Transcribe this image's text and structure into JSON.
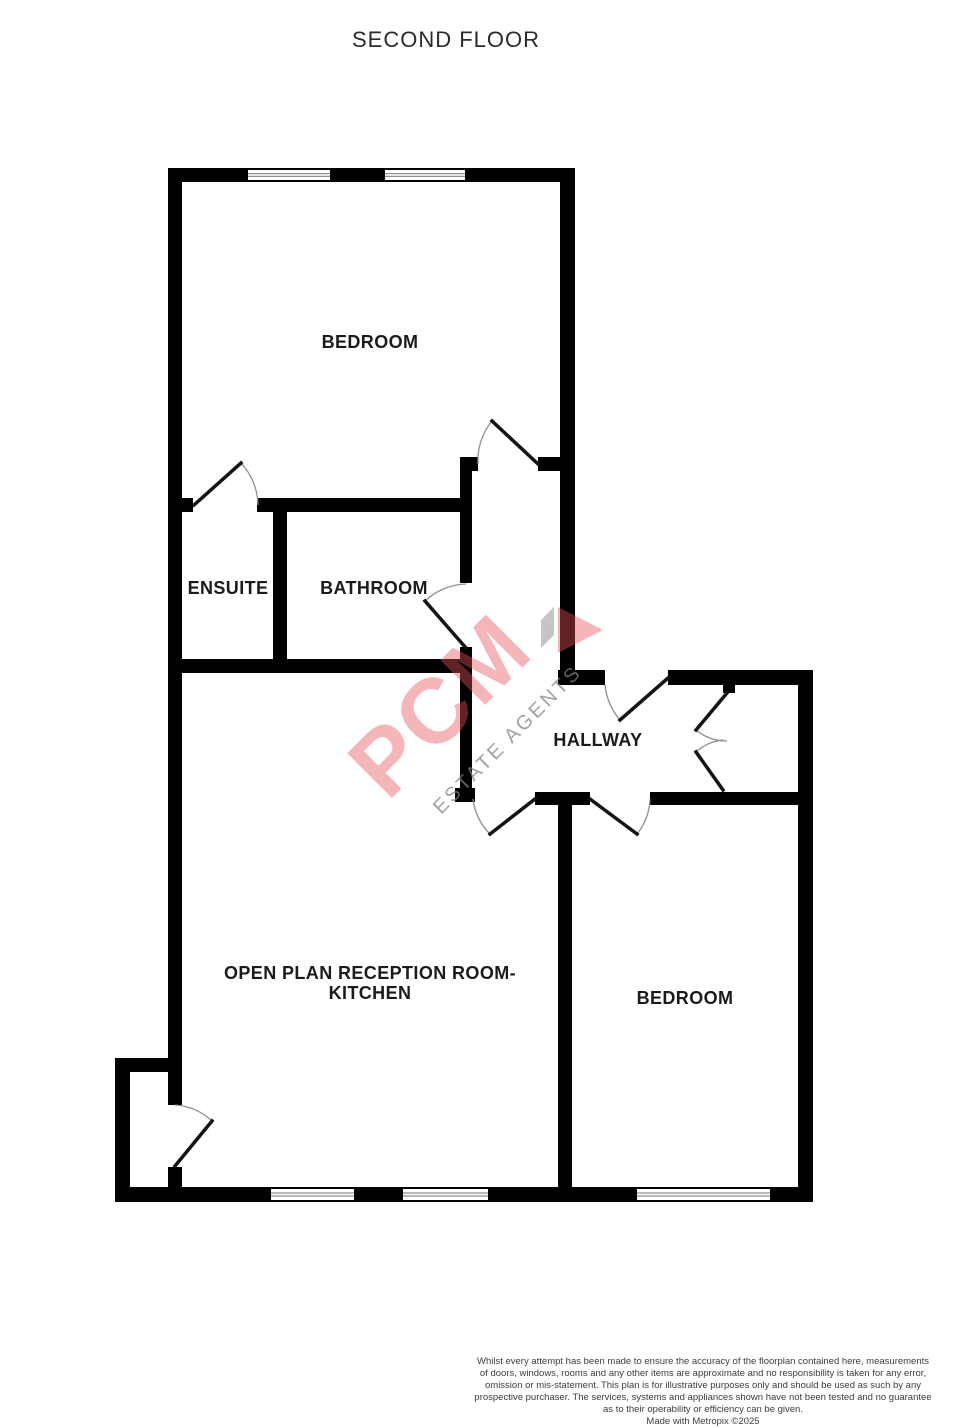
{
  "title": "SECOND FLOOR",
  "style": {
    "wall_color": "#000000",
    "door_leaf_color": "#141414",
    "door_arc_color": "#8f8f8f",
    "window_line_color": "#8f8f8f",
    "label_color": "#1b1b1b"
  },
  "watermark": {
    "texts": [
      {
        "text": "PCM",
        "x": 462,
        "y": 728,
        "size": 92,
        "rotate": -45,
        "color": "rgba(232,80,90,0.42)",
        "weight": "bold",
        "spacing": 2
      },
      {
        "text": "ESTATE AGENTS",
        "x": 512,
        "y": 744,
        "size": 20,
        "rotate": -45,
        "color": "rgba(130,130,130,0.75)",
        "weight": "normal",
        "spacing": 3
      }
    ],
    "polygons": [
      {
        "name": "watermark-gray-bar",
        "points": "541,648 541,620 554,607 554,635",
        "color": "rgba(150,150,150,0.55)"
      },
      {
        "name": "watermark-arrow",
        "points": "558,607 603,630 558,653",
        "color": "rgba(232,80,90,0.42)"
      }
    ]
  },
  "plan": {
    "walls": [
      [
        168,
        168,
        80,
        14
      ],
      [
        330,
        168,
        55,
        14
      ],
      [
        465,
        168,
        110,
        14
      ],
      [
        168,
        168,
        14,
        904
      ],
      [
        560,
        168,
        15,
        517
      ],
      [
        168,
        498,
        25,
        14
      ],
      [
        257,
        498,
        215,
        14
      ],
      [
        460,
        457,
        18,
        14
      ],
      [
        538,
        457,
        22,
        14
      ],
      [
        273,
        512,
        14,
        148
      ],
      [
        168,
        659,
        304,
        14
      ],
      [
        460,
        471,
        12,
        112
      ],
      [
        460,
        647,
        12,
        141
      ],
      [
        455,
        788,
        20,
        14
      ],
      [
        558,
        670,
        47,
        15
      ],
      [
        668,
        670,
        145,
        15
      ],
      [
        723,
        683,
        12,
        10
      ],
      [
        798,
        670,
        15,
        532
      ],
      [
        535,
        792,
        55,
        13
      ],
      [
        650,
        792,
        155,
        13
      ],
      [
        558,
        792,
        14,
        410
      ],
      [
        115,
        1058,
        67,
        14
      ],
      [
        115,
        1058,
        15,
        144
      ],
      [
        168,
        1072,
        14,
        33
      ],
      [
        168,
        1167,
        14,
        20
      ],
      [
        115,
        1187,
        156,
        15
      ],
      [
        354,
        1187,
        49,
        15
      ],
      [
        488,
        1187,
        149,
        15
      ],
      [
        770,
        1187,
        43,
        15
      ]
    ],
    "windows": [
      [
        248,
        168,
        82,
        14
      ],
      [
        385,
        168,
        80,
        14
      ],
      [
        271,
        1187,
        83,
        15
      ],
      [
        403,
        1187,
        85,
        15
      ],
      [
        637,
        1187,
        133,
        15
      ]
    ],
    "doors": [
      {
        "name": "ensuite-door",
        "leaf": [
          194,
          505,
          241,
          463
        ],
        "arc": "M241,463 A63,63 0 0 1 258,505"
      },
      {
        "name": "bedroom-top-door",
        "leaf": [
          538,
          464,
          492,
          421
        ],
        "arc": "M492,421 A62,62 0 0 0 478,464"
      },
      {
        "name": "bathroom-door",
        "leaf": [
          466,
          648,
          425,
          601
        ],
        "arc": "M425,601 A63,63 0 0 1 466,584"
      },
      {
        "name": "hallway-top-door",
        "leaf": [
          668,
          678,
          620,
          720
        ],
        "arc": "M620,720 A64,64 0 0 1 605,685"
      },
      {
        "name": "entrance-door-upper",
        "leaf": [
          727,
          693,
          696,
          730
        ],
        "arc": "M727,741 A48,48 0 0 1 696,730"
      },
      {
        "name": "entrance-door-lower",
        "leaf": [
          723,
          790,
          696,
          752
        ],
        "arc": "M723,740 A48,48 0 0 0 696,752"
      },
      {
        "name": "reception-door",
        "leaf": [
          535,
          799,
          490,
          834
        ],
        "arc": "M473,799 A60,60 0 0 0 490,834"
      },
      {
        "name": "bedroom-right-door",
        "leaf": [
          590,
          799,
          637,
          834
        ],
        "arc": "M650,799 A59,59 0 0 1 637,834"
      },
      {
        "name": "lobby-door",
        "leaf": [
          175,
          1166,
          212,
          1121
        ],
        "arc": "M175,1105 A60,60 0 0 1 212,1121"
      }
    ],
    "labels": [
      {
        "id": "bedroom-top",
        "text": "BEDROOM",
        "x": 370,
        "y": 342
      },
      {
        "id": "ensuite",
        "text": "ENSUITE",
        "x": 228,
        "y": 588
      },
      {
        "id": "bathroom",
        "text": "BATHROOM",
        "x": 374,
        "y": 588
      },
      {
        "id": "hallway",
        "text": "HALLWAY",
        "x": 598,
        "y": 740
      },
      {
        "id": "reception",
        "text": "OPEN PLAN RECEPTION ROOM-\nKITCHEN",
        "x": 370,
        "y": 983
      },
      {
        "id": "bedroom-right",
        "text": "BEDROOM",
        "x": 685,
        "y": 998
      }
    ]
  },
  "disclaimer": {
    "lines": [
      "Whilst every attempt has been made to ensure the accuracy of the floorplan contained here, measurements",
      "of doors, windows, rooms and any other items are approximate and no responsibility is taken for any error,",
      "omission or mis-statement. This plan is for illustrative purposes only and should be used as such by any",
      "prospective purchaser. The services, systems and appliances shown have not been tested and no guarantee",
      "as to their operability or efficiency can be given.",
      "Made with Metropix ©2025"
    ]
  }
}
